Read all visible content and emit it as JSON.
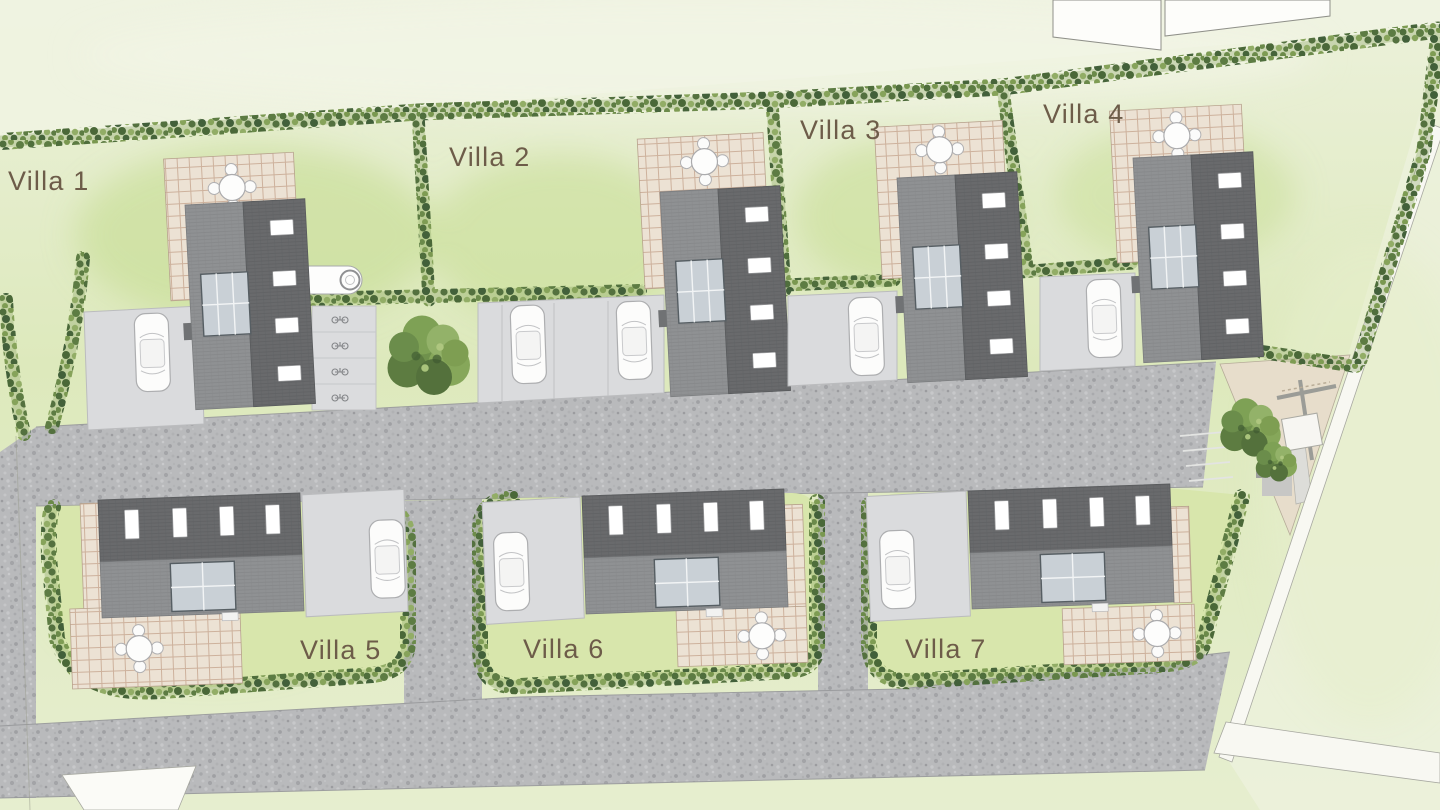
{
  "plan": {
    "villas": [
      {
        "label": "Villa 1"
      },
      {
        "label": "Villa 2"
      },
      {
        "label": "Villa 3"
      },
      {
        "label": "Villa 4"
      },
      {
        "label": "Villa 5"
      },
      {
        "label": "Villa 6"
      },
      {
        "label": "Villa 7"
      }
    ],
    "palette": {
      "label_text": "#6d5c49",
      "lawn": "#dde9bc",
      "lawn_bright": "#c3db8d",
      "lawn_pale": "#eff3e1",
      "hedge_green": "#54713f",
      "gravel_road": "#b9babc",
      "driveway": "#dadbdd",
      "roof_dark": "#696a6c",
      "roof_light": "#8f9193",
      "glass": "#c9d0d6",
      "window": "#ffffff",
      "patio_tile": "#ece2d4",
      "white_path": "#f8f8f2"
    }
  }
}
